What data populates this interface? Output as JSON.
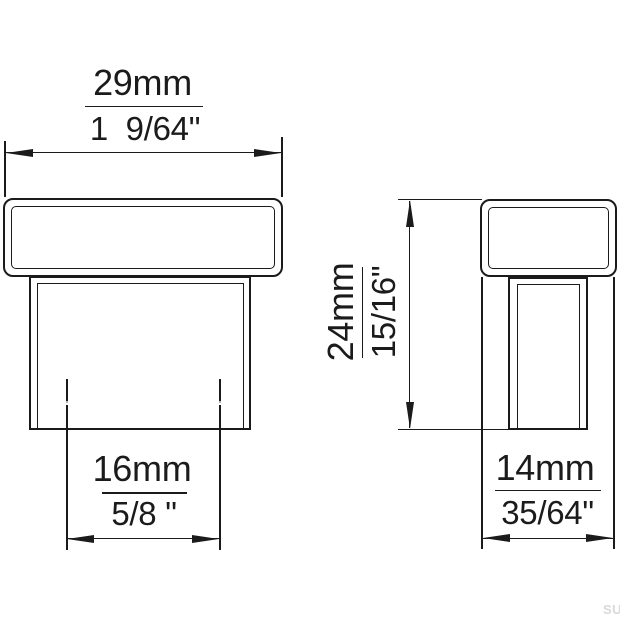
{
  "colors": {
    "line": "#1b1b1b",
    "watermark": "#d9d9d9",
    "background": "#ffffff"
  },
  "watermark": {
    "text": "SU"
  },
  "dimensions": {
    "width": {
      "mm": "29mm",
      "inch": "1  9/64\""
    },
    "base": {
      "mm": "16mm",
      "inch": "5/8 \""
    },
    "height": {
      "mm": "24mm",
      "inch": "15/16\""
    },
    "depth": {
      "mm": "14mm",
      "inch": "35/64\""
    }
  }
}
